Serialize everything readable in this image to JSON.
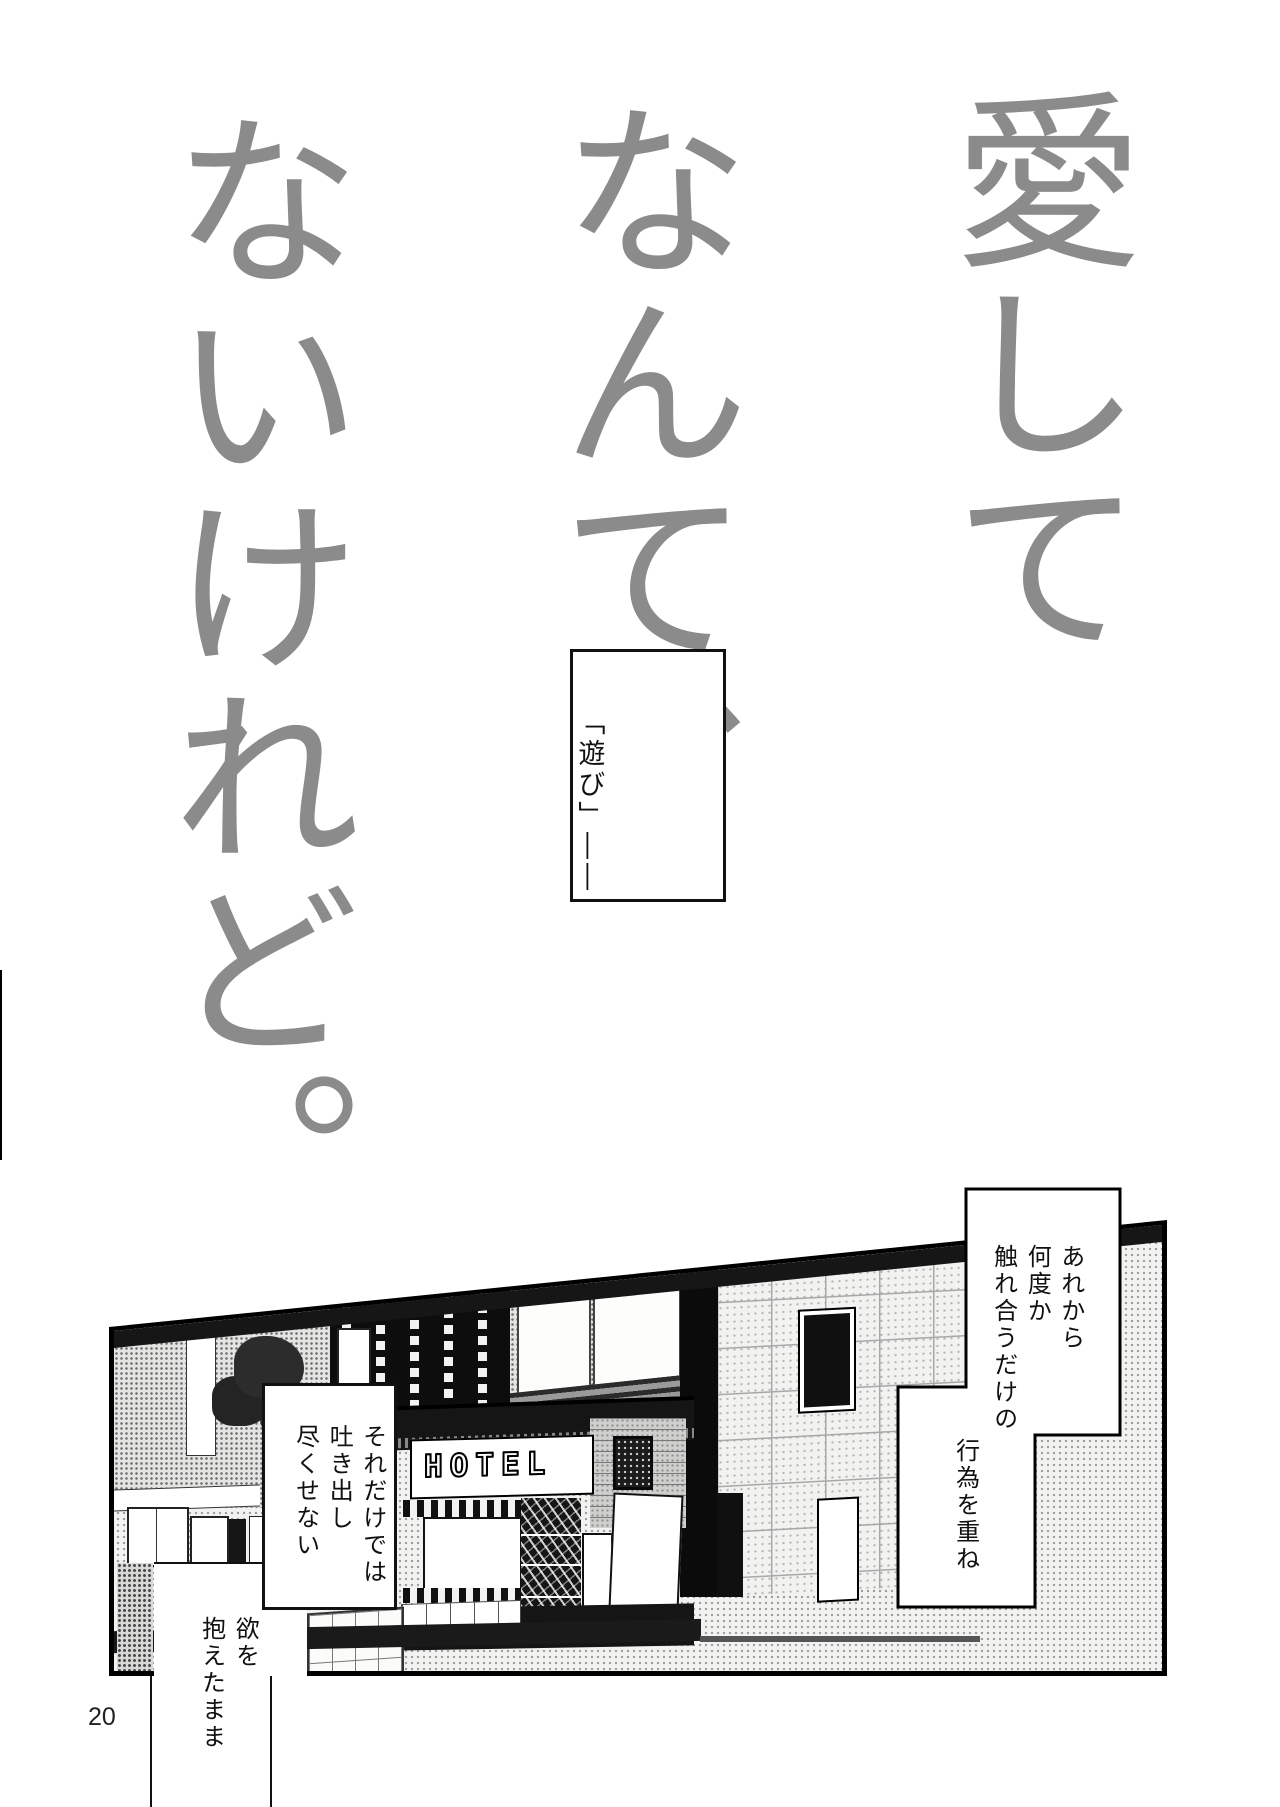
{
  "page": {
    "number": "20",
    "background_color": "#ffffff",
    "ink_color": "#111111",
    "title_color": "#8b8b8b"
  },
  "title": {
    "columns": [
      "愛して",
      "なんて、",
      "ないけれど。"
    ]
  },
  "captions": {
    "asobi": "「遊び」――",
    "arekara_lines": [
      "あれから",
      "何度か",
      "触れ合うだけの"
    ],
    "koui": "行為を重ね",
    "soredake_lines": [
      "それだけでは",
      "吐き出し",
      "尽くせない"
    ],
    "yoku_lines": [
      "欲を",
      "抱えたまま"
    ]
  },
  "panel": {
    "hotel_sign": "HOTEL"
  }
}
